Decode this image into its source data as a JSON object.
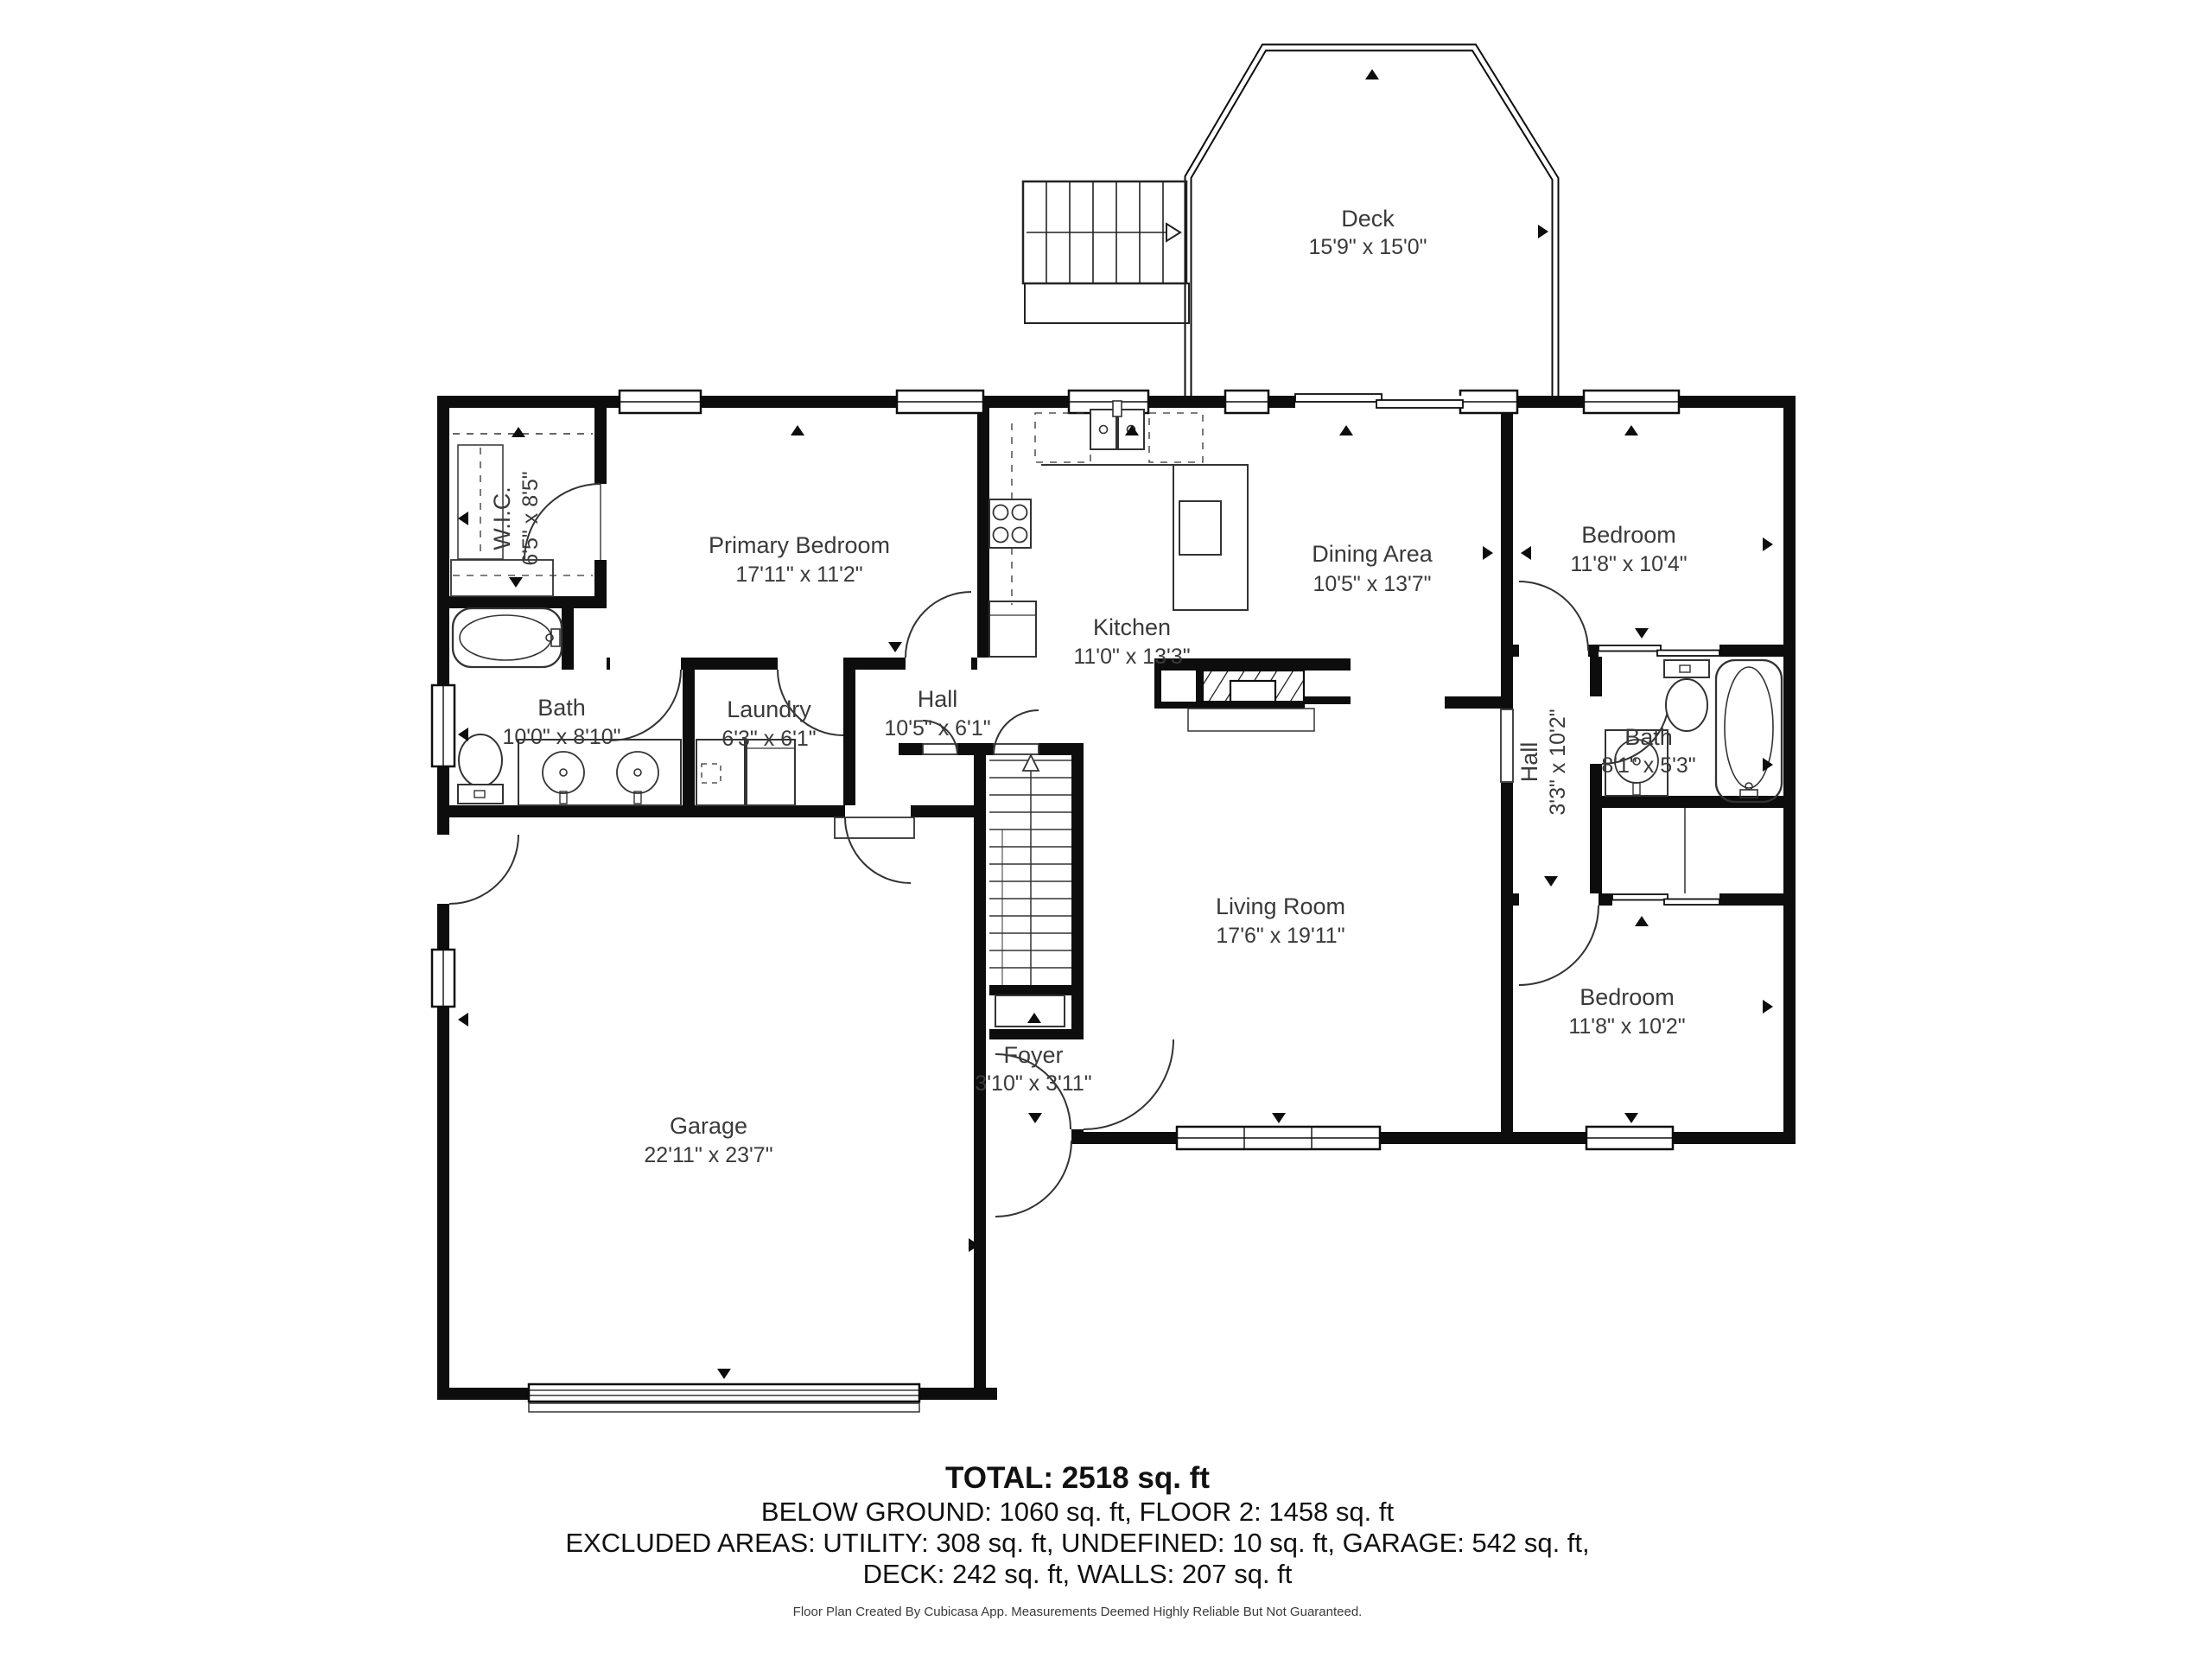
{
  "rooms": {
    "deck": {
      "name": "Deck",
      "dims": "15'9\" x 15'0\""
    },
    "wic": {
      "name": "W.I.C.",
      "dims": "6'5\" x 8'5\""
    },
    "primary_bedroom": {
      "name": "Primary Bedroom",
      "dims": "17'11\" x 11'2\""
    },
    "kitchen": {
      "name": "Kitchen",
      "dims": "11'0\" x 13'3\""
    },
    "dining_area": {
      "name": "Dining Area",
      "dims": "10'5\" x 13'7\""
    },
    "bedroom_top": {
      "name": "Bedroom",
      "dims": "11'8\" x 10'4\""
    },
    "bath_left": {
      "name": "Bath",
      "dims": "10'0\" x 8'10\""
    },
    "laundry": {
      "name": "Laundry",
      "dims": "6'3\" x 6'1\""
    },
    "hall_center": {
      "name": "Hall",
      "dims": "10'5\" x 6'1\""
    },
    "hall_right": {
      "name": "Hall",
      "dims": "3'3\" x 10'2\""
    },
    "bath_right": {
      "name": "Bath",
      "dims": "8'1\" x 5'3\""
    },
    "living_room": {
      "name": "Living Room",
      "dims": "17'6\" x 19'11\""
    },
    "bedroom_bottom": {
      "name": "Bedroom",
      "dims": "11'8\" x 10'2\""
    },
    "garage": {
      "name": "Garage",
      "dims": "22'11\" x 23'7\""
    },
    "foyer": {
      "name": "Foyer",
      "dims": "3'10\" x 3'11\""
    }
  },
  "summary": {
    "total": "TOTAL: 2518 sq. ft",
    "line2": "BELOW GROUND: 1060 sq. ft, FLOOR 2: 1458 sq. ft",
    "line3": "EXCLUDED AREAS: UTILITY: 308 sq. ft, UNDEFINED: 10 sq. ft, GARAGE: 542 sq. ft,",
    "line4": "DECK: 242 sq. ft, WALLS: 207 sq. ft"
  },
  "footer": "Floor Plan Created By Cubicasa App. Measurements Deemed Highly Reliable But Not Guaranteed.",
  "colors": {
    "wall": "#0d0d0d",
    "line": "#333333",
    "text": "#3a3a3a"
  }
}
